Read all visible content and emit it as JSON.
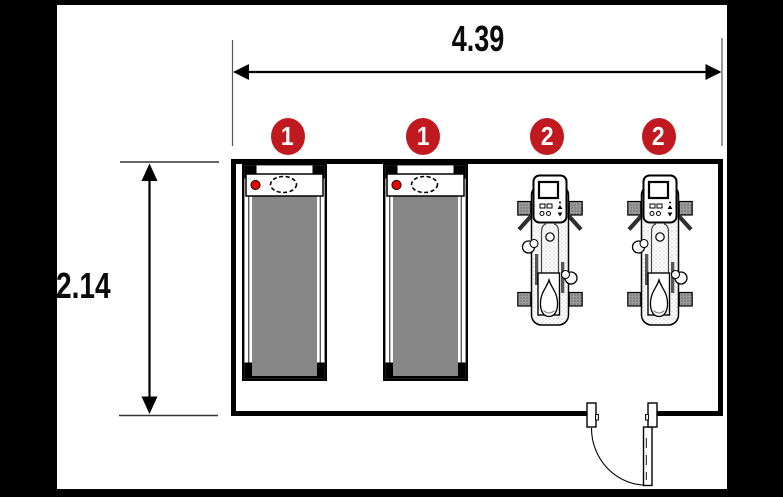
{
  "diagram": {
    "type": "floor-plan",
    "dimensions": {
      "width": "4.39",
      "height": "2.14"
    },
    "markers": [
      {
        "number": "1",
        "equipment": "treadmill"
      },
      {
        "number": "1",
        "equipment": "treadmill"
      },
      {
        "number": "2",
        "equipment": "weight-machine"
      },
      {
        "number": "2",
        "equipment": "weight-machine"
      }
    ],
    "colors": {
      "marker_red": "#c0191f",
      "indicator_red": "#e80000",
      "belt_gray": "#878787",
      "pad_gray": "#9b9b9b",
      "wall_black": "#000000",
      "background_black": "#000000",
      "paper_white": "#ffffff"
    }
  }
}
